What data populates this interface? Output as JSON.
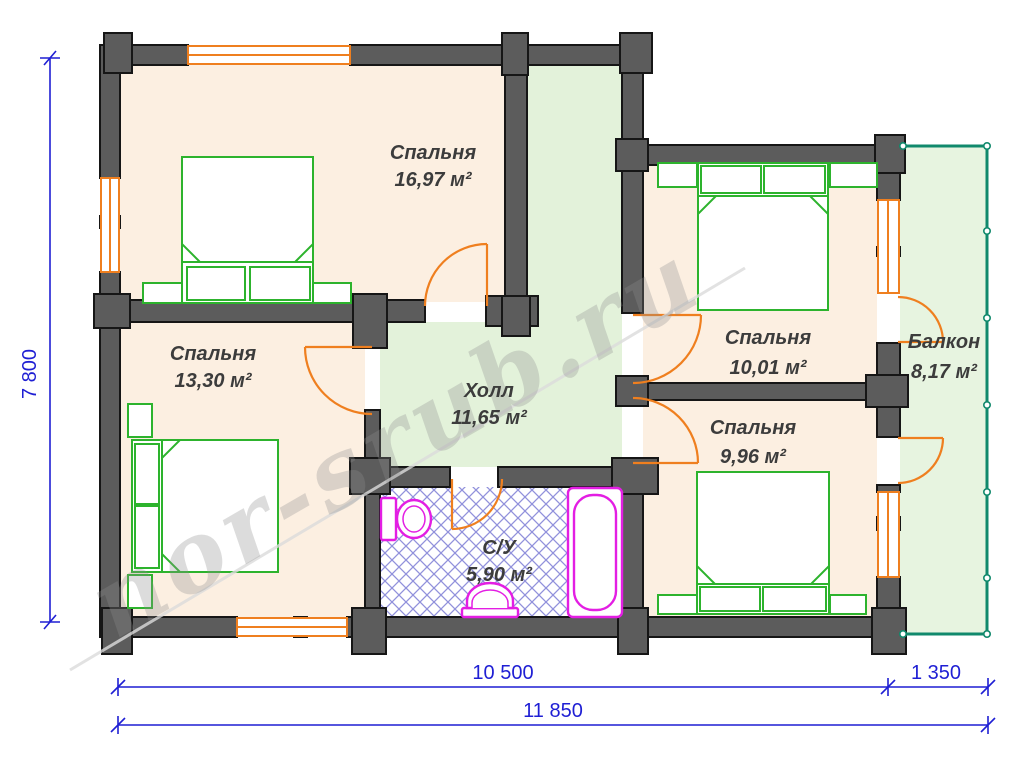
{
  "watermark": "nor-srub.ru",
  "rooms": {
    "bedroom1": {
      "name": "Спальня",
      "area": "16,97 м²"
    },
    "bedroom2": {
      "name": "Спальня",
      "area": "13,30 м²"
    },
    "bedroom3": {
      "name": "Спальня",
      "area": "10,01 м²"
    },
    "bedroom4": {
      "name": "Спальня",
      "area": "9,96 м²"
    },
    "hall": {
      "name": "Холл",
      "area": "11,65 м²"
    },
    "balcony": {
      "name": "Балкон",
      "area": "8,17 м²"
    },
    "bathroom": {
      "name": "С/У",
      "area": "5,90 м²"
    }
  },
  "dimensions": {
    "left_height": "7 800",
    "bottom_main": "10 500",
    "bottom_balcony": "1 350",
    "bottom_total": "11 850"
  },
  "colors": {
    "wall": "#5c5c5c",
    "wall_outline": "#161616",
    "bedroom_floor": "#fcefe1",
    "hall_floor": "#e3f2da",
    "balcony_floor": "#e7f4e0",
    "window_door": "#ef7f1f",
    "furniture": "#2db32d",
    "fixture": "#e31ee3",
    "hatch": "#9191dc",
    "railing": "#11896c",
    "dimension": "#1f1fd4"
  }
}
